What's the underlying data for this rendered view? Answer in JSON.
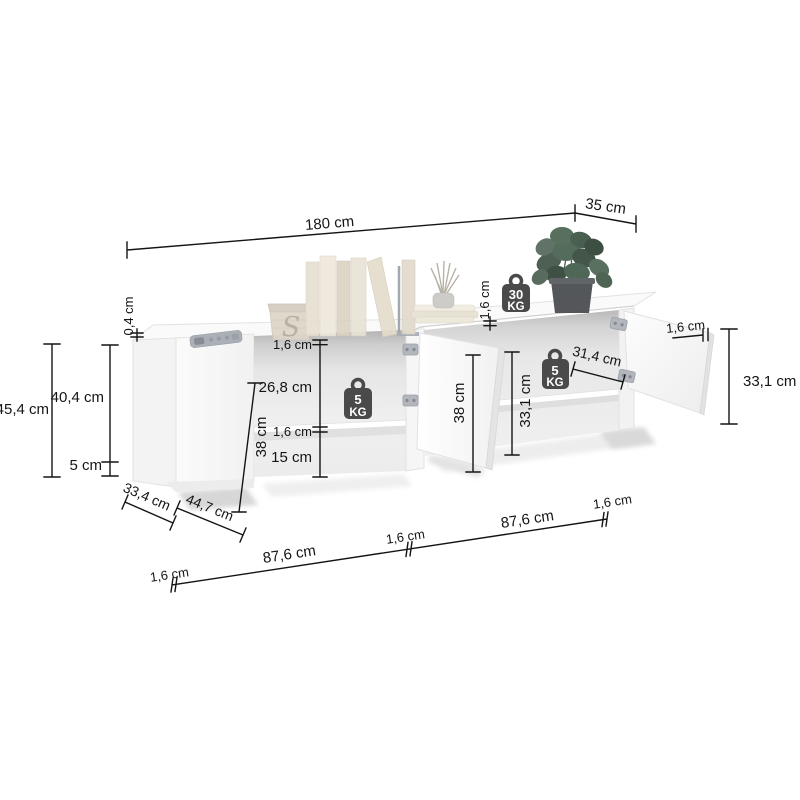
{
  "diagram": {
    "type": "furniture-dimension-diagram",
    "product": "TV stand with open doors and shelves"
  },
  "labels": {
    "w180": "180 cm",
    "d35": "35 cm",
    "h454": "45,4 cm",
    "h404": "40,4 cm",
    "h5": "5 cm",
    "t04": "0,4 cm",
    "t16a": "1,6 cm",
    "o268": "26,8 cm",
    "t16b": "1,6 cm",
    "o15": "15 cm",
    "i38l": "38 cm",
    "i38m": "38 cm",
    "i331": "33,1 cm",
    "s314": "31,4 cm",
    "t16c": "1,6 cm",
    "t16d": "1,6 cm",
    "h331r": "33,1 cm",
    "d334": "33,4 cm",
    "w447": "44,7 cm",
    "g16a": "1,6 cm",
    "w876a": "87,6 cm",
    "g16b": "1,6 cm",
    "w876b": "87,6 cm",
    "g16c": "1,6 cm"
  },
  "badges": {
    "b30": {
      "value": "30",
      "unit": "KG"
    },
    "b5l": {
      "value": "5",
      "unit": "KG"
    },
    "b5r": {
      "value": "5",
      "unit": "KG"
    }
  },
  "decor": {
    "basket_monogram": "S"
  },
  "colors": {
    "line": "#141414",
    "badge": "#4a4a4a",
    "cabinet": "#fcfcfc",
    "interior_shadow": "#bcbcbc",
    "metal": "#b3b7bd",
    "plant_green": "#41594a",
    "basket": "#ddd6c9"
  }
}
